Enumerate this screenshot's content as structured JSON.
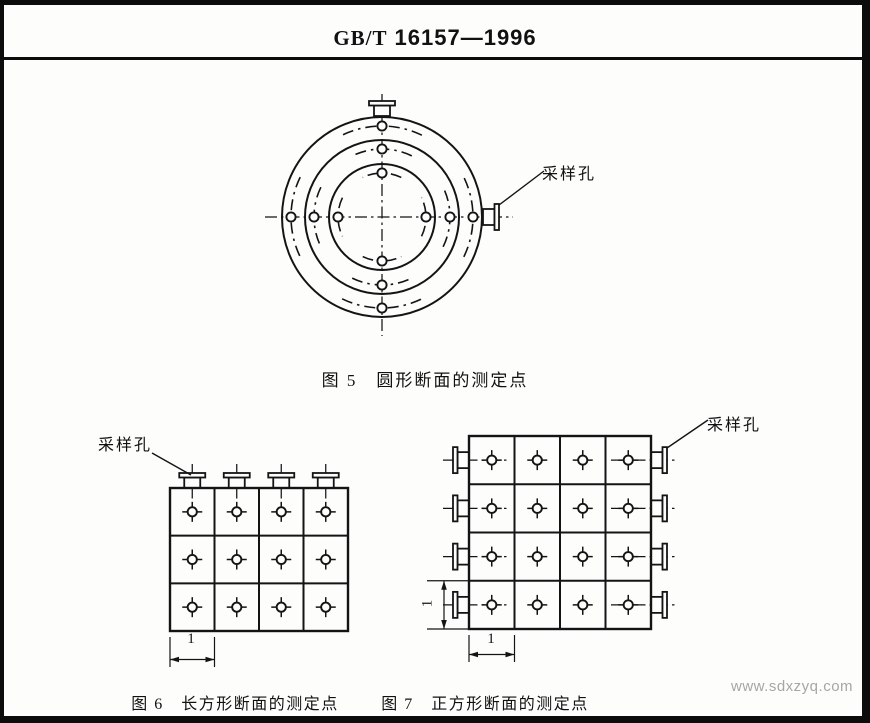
{
  "header": {
    "standard_prefix": "GB/T",
    "standard_number": "16157—1996"
  },
  "figures": {
    "fig5": {
      "caption": "图 5　圆形断面的测定点",
      "sampling_label": "采样孔"
    },
    "fig6": {
      "caption": "图 6　长方形断面的测定点",
      "sampling_label": "采样孔",
      "dim_label": "1"
    },
    "fig7": {
      "caption": "图 7　正方形断面的测定点",
      "sampling_label": "采样孔",
      "dim_bottom_label": "1",
      "dim_left_label": "1"
    }
  },
  "watermark": "www.sdxzyq.com"
}
